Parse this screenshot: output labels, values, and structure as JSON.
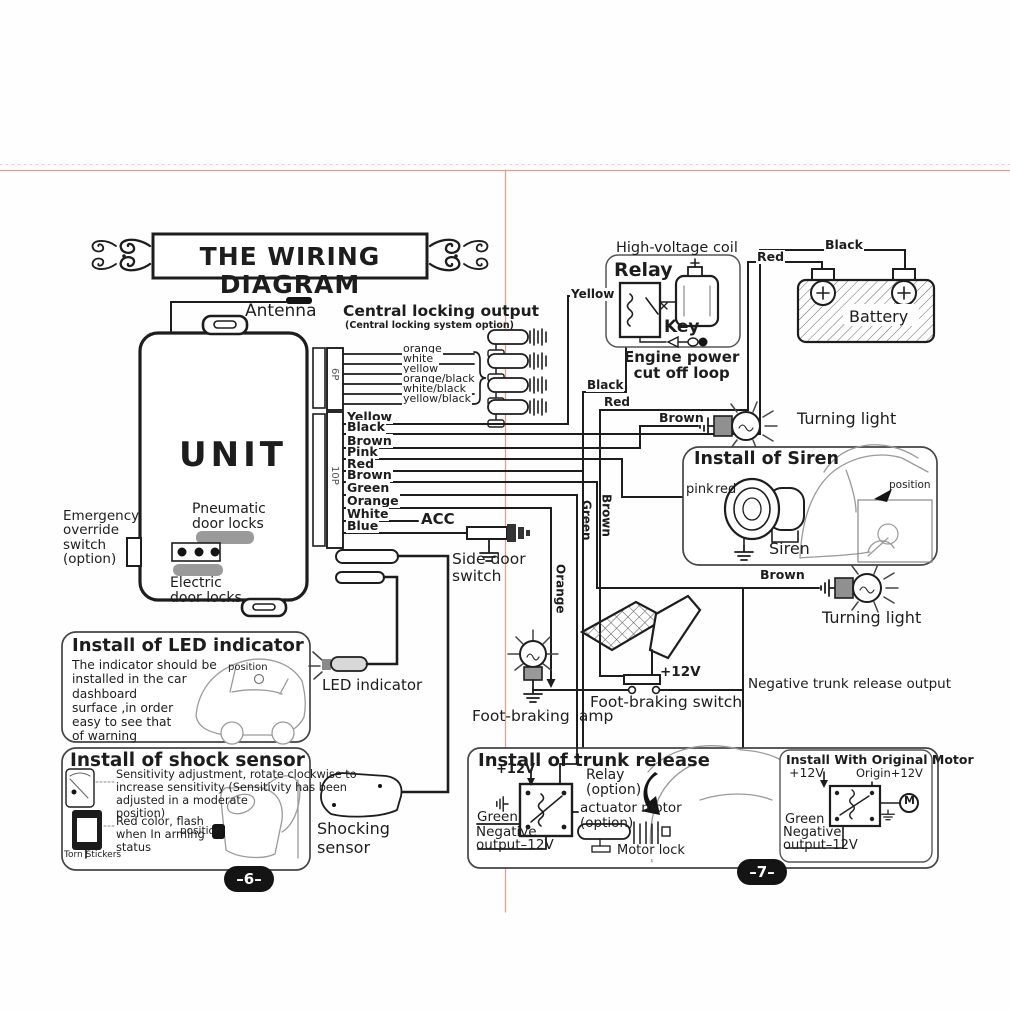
{
  "title": "THE WIRING DIAGRAM",
  "pages": {
    "left": "–6–",
    "right": "–7–"
  },
  "colors": {
    "ink": "#1d1d1d",
    "fold_line": "#dfa195",
    "badge_bg": "#141414"
  },
  "unit": {
    "name": "UNIT",
    "antenna": "Antenna",
    "pneumatic": "Pneumatic\ndoor locks",
    "electric": "Electric\ndoor locks",
    "emergency": "Emergency\noverride\nswitch\n(option)",
    "p6": "6P",
    "p10": "10P"
  },
  "central_locking": {
    "heading": "Central locking output",
    "subheading": "(Central locking system option)",
    "wire1": "orange",
    "wire2": "white",
    "wire3": "yellow",
    "wire4": "orange/black",
    "wire5": "white/black",
    "wire6": "yellow/black"
  },
  "harness": {
    "w1": "Yellow",
    "w2": "Black",
    "w3": "Brown",
    "w4": "Pink",
    "w5": "Red",
    "w6": "Brown",
    "w7": "Green",
    "w8": "Orange",
    "w9": "White",
    "w10": "Blue",
    "acc": "ACC",
    "side_door_switch": "Side door\nswitch",
    "tag_yellow": "Yellow",
    "tag_black": "Black",
    "tag_red": "Red",
    "tag_green": "Green",
    "tag_brown": "Brown",
    "tag_orange": "Orange"
  },
  "engine": {
    "coil": "High-voltage coil",
    "relay": "Relay",
    "key": "Key",
    "loop": "Engine power\ncut off loop"
  },
  "battery": {
    "label": "Battery",
    "black": "Black",
    "red": "Red"
  },
  "turning_light_top": {
    "wire": "Brown",
    "label": "Turning light"
  },
  "turning_light_bottom": {
    "wire": "Brown",
    "label": "Turning light"
  },
  "siren_box": {
    "heading": "Install of Siren",
    "pink": "pink",
    "red": "red",
    "siren": "Siren",
    "position": "position"
  },
  "foot": {
    "lamp": "Foot-braking lamp",
    "switch": "Foot-braking switch",
    "v12": "+12V"
  },
  "trunk_output": "Negative trunk release output",
  "led_box": {
    "heading": "Install of LED indicator",
    "body": "The indicator should be\ninstalled in the car\ndashboard\nsurface ,in order\neasy to see that\nof warning",
    "position": "position",
    "label": "LED indicator"
  },
  "shock_box": {
    "heading": "Install of shock sensor",
    "sensitivity": "Sensitivity adjustment, rotate clockwise to\nincrease sensitivity (Sensitivity has been\nadjusted in a moderate\nposition)",
    "red_flash": "Red color, flash\nwhen In arming\nstatus",
    "torn": "Torn Stickers",
    "position": "position",
    "label": "Shocking\nsensor"
  },
  "trunk_box": {
    "heading": "Install of trunk release",
    "v12": "+12V",
    "relay": "Relay\n(option)",
    "actuator": "actuator motor\n(option)",
    "green": "Green",
    "negative": "Negative\noutput–12V",
    "motor_lock": "Motor lock"
  },
  "original_motor_box": {
    "heading": "Install With Original Motor",
    "v12": "+12V",
    "origin": "Origin+12V",
    "motor": "M",
    "green": "Green",
    "negative": "Negative\noutput–12V"
  }
}
